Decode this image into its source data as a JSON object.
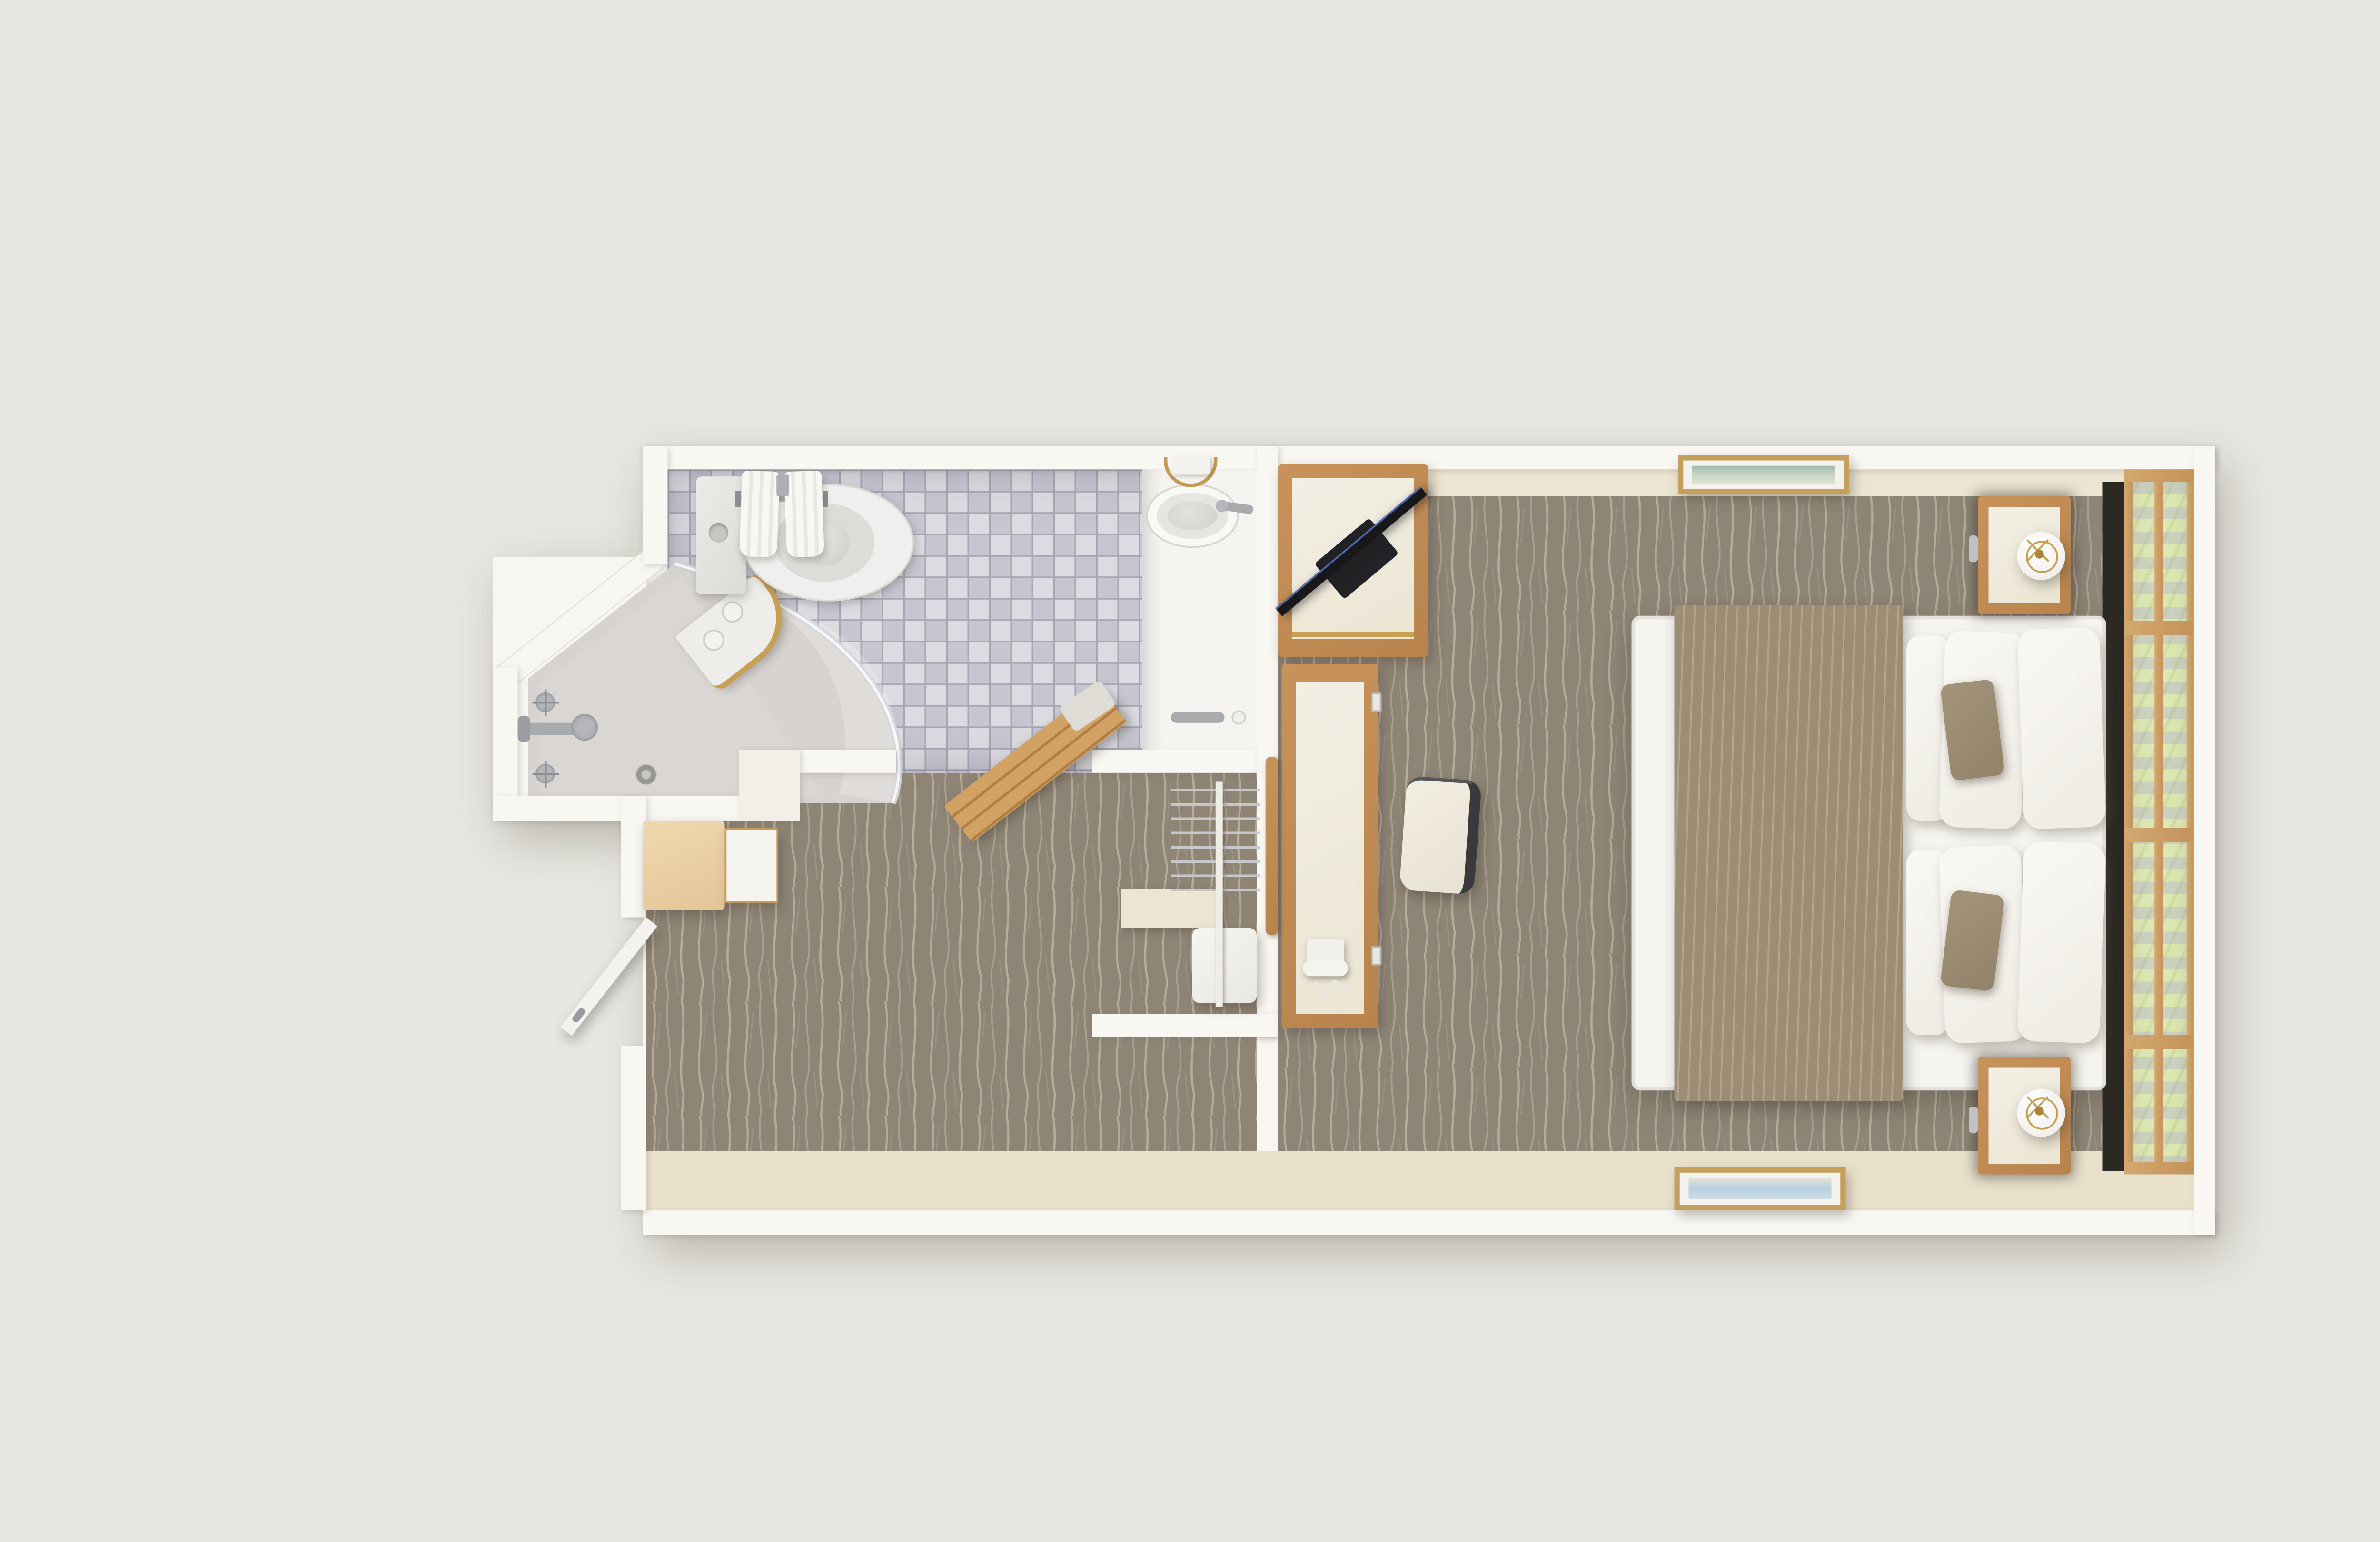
{
  "meta": {
    "title": "Top-down 3D floor plan render of a hotel guest room",
    "type": "architectural-floor-plan-render",
    "view": "top-down orthographic 3D render",
    "background_color": "#e9e7e2"
  },
  "palette": {
    "background": "#e9e7e2",
    "walls": "#f9f7f2",
    "tile_light": "#dcdbe1",
    "tile_dark": "#c6c5d0",
    "tile_grout": "#a7a6b2",
    "carpet_base": "#8f8576",
    "carpet_lines": "#c3b79f",
    "floor_strip_beige": "#e9e1cc",
    "wood_medium": "#c18c54",
    "wood_light": "#ecd3a9",
    "wood_window_frame": "#c99d64",
    "bedding_white": "#f6f4ef",
    "runner_taupe": "#9d8d74",
    "accent_pillow_taupe": "#9a8a72",
    "curtain_green": "#dde7b2",
    "curtain_gray": "#ccd2bf",
    "tv_black": "#18181b",
    "gold_accent": "#c7a055",
    "headboard_dark": "#2c2822",
    "shower_floor": "#d6d3d0"
  },
  "rooms": [
    {
      "id": "bathroom",
      "label": "Bathroom",
      "floor": "blue-gray checkerboard mosaic tile",
      "fixtures": [
        "toilet with tank and flush button",
        "vanity counter with oval sink basin and faucet",
        "corner shower with curved glass, drain, valves and spout",
        "corner shower shelf with two toiletry bottles",
        "towel bar with two hanging towels",
        "gold towel ring",
        "teak slat bath mat at doorway"
      ]
    },
    {
      "id": "entry-hall",
      "label": "Entry hall",
      "floor": "taupe patterned carpet",
      "fixtures": [
        "open entry door",
        "wall-hung wood drawer cabinet"
      ]
    },
    {
      "id": "closet",
      "label": "Closet alcove",
      "floor": "taupe patterned carpet",
      "fixtures": [
        "clothes rod",
        "wire hangers",
        "white fabric storage cube",
        "cream shelf"
      ]
    },
    {
      "id": "bedroom",
      "label": "Bedroom",
      "floor": "taupe patterned carpet",
      "fixtures": [
        "bed with white bedding and taupe runner",
        "white pillows",
        "taupe accent pillows",
        "dark headboard panel",
        "two nightstands with gold-frame drum lamps",
        "corner TV cabinet with diagonal flat-screen TV",
        "work desk with corded telephone",
        "upholstered desk chair with dark frame",
        "wall grab bar",
        "light switches",
        "framed landscape artwork on top wall",
        "framed seascape artwork on bottom wall",
        "window wall with wood mullions and green striped curtains"
      ]
    }
  ],
  "counts": {
    "rooms": 4,
    "beds": 1,
    "pillows_white": 6,
    "pillows_accent": 2,
    "nightstands": 2,
    "lamps": 2,
    "artworks": 2,
    "towels_on_bar": 2,
    "toiletry_bottles": 2,
    "hangers": 8,
    "doors_visible": 1,
    "tv": 1,
    "telephones": 1
  }
}
